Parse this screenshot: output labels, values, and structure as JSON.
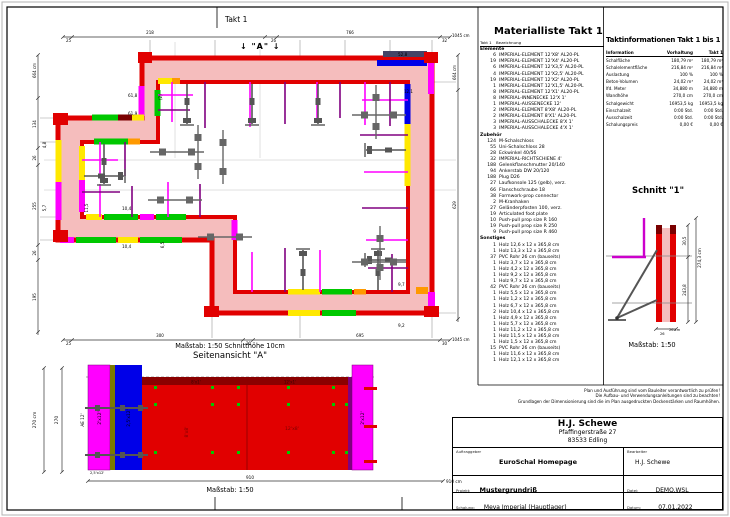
{
  "colors": {
    "formwork_red": "#e10000",
    "dark_red": "#7a0000",
    "wall_pink": "#f5bdbd",
    "magenta": "#ff00ff",
    "blue": "#0000e8",
    "green": "#00c800",
    "yellow": "#ffe800",
    "orange": "#ff9900",
    "purple_prop": "#800080",
    "tie_gray": "#555555"
  },
  "plan": {
    "title": "Takt 1",
    "section_marker": "↓ \"A\" ↓",
    "scale_note": "Maßstab: 1:50   Schnitthöhe 10cm",
    "labels": [
      {
        "t": "25",
        "x": 66,
        "y": 42,
        "s": 4
      },
      {
        "t": "218",
        "x": 150,
        "y": 34,
        "s": 4,
        "a": "middle"
      },
      {
        "t": "26",
        "x": 271,
        "y": 42,
        "s": 4
      },
      {
        "t": "766",
        "x": 350,
        "y": 34,
        "s": 4,
        "a": "middle"
      },
      {
        "t": "32",
        "x": 442,
        "y": 42,
        "s": 4
      },
      {
        "t": "1045 cm",
        "x": 452,
        "y": 37,
        "s": 4
      },
      {
        "t": "25",
        "x": 66,
        "y": 345,
        "s": 4
      },
      {
        "t": "300",
        "x": 160,
        "y": 337,
        "s": 4,
        "a": "middle"
      },
      {
        "t": "20",
        "x": 246,
        "y": 345,
        "s": 4
      },
      {
        "t": "695",
        "x": 360,
        "y": 337,
        "s": 4,
        "a": "middle"
      },
      {
        "t": "30",
        "x": 442,
        "y": 345,
        "s": 4
      },
      {
        "t": "1045 cm",
        "x": 452,
        "y": 341,
        "s": 4
      },
      {
        "t": "664 cm",
        "x": 36,
        "y": 78,
        "r": -90,
        "s": 4
      },
      {
        "t": "134",
        "x": 36,
        "y": 124,
        "r": -90,
        "s": 4,
        "a": "middle"
      },
      {
        "t": "26",
        "x": 36,
        "y": 158,
        "r": -90,
        "s": 4,
        "a": "middle"
      },
      {
        "t": "255",
        "x": 36,
        "y": 206,
        "r": -90,
        "s": 4,
        "a": "middle"
      },
      {
        "t": "26",
        "x": 36,
        "y": 253,
        "r": -90,
        "s": 4,
        "a": "middle"
      },
      {
        "t": "195",
        "x": 36,
        "y": 297,
        "r": -90,
        "s": 4,
        "a": "middle"
      },
      {
        "t": "664 cm",
        "x": 456,
        "y": 80,
        "r": -90,
        "s": 4
      },
      {
        "t": "629",
        "x": 456,
        "y": 205,
        "r": -90,
        "s": 4,
        "a": "middle"
      },
      {
        "t": "52,8",
        "x": 398,
        "y": 56,
        "s": 4.2
      },
      {
        "t": "12,1",
        "x": 404,
        "y": 93,
        "s": 4
      },
      {
        "t": "(2)",
        "x": 162,
        "y": 100,
        "r": -90,
        "s": 4
      },
      {
        "t": "61,8",
        "x": 128,
        "y": 97,
        "s": 4.2
      },
      {
        "t": "61,9",
        "x": 128,
        "y": 115,
        "s": 4.2
      },
      {
        "t": "4,8",
        "x": 46,
        "y": 145,
        "r": -90,
        "s": 4,
        "a": "middle"
      },
      {
        "t": "5,7",
        "x": 46,
        "y": 208,
        "r": -90,
        "s": 4,
        "a": "middle"
      },
      {
        "t": "11,5",
        "x": 88,
        "y": 208,
        "r": -90,
        "s": 4,
        "a": "middle"
      },
      {
        "t": "10,4",
        "x": 122,
        "y": 210,
        "s": 4.2
      },
      {
        "t": "10,4",
        "x": 122,
        "y": 248,
        "s": 4.2
      },
      {
        "t": "6,5",
        "x": 164,
        "y": 245,
        "r": -90,
        "s": 4,
        "a": "middle"
      },
      {
        "t": "9,7",
        "x": 398,
        "y": 286,
        "s": 4.2
      },
      {
        "t": "9,2",
        "x": 398,
        "y": 327,
        "s": 4.2
      }
    ]
  },
  "side_view": {
    "title": "Seitenansicht \"A\"",
    "scale": "Maßstab: 1:50",
    "labels": [
      {
        "t": "270 cm",
        "x": 36,
        "y": 420,
        "r": -90,
        "s": 4.4,
        "a": "middle"
      },
      {
        "t": "270",
        "x": 58,
        "y": 420,
        "r": -90,
        "s": 4.4,
        "a": "middle"
      },
      {
        "t": "AE 12'",
        "x": 84,
        "y": 420,
        "r": -90,
        "s": 4.2,
        "a": "middle"
      },
      {
        "t": "2'x12'",
        "x": 101,
        "y": 418,
        "r": -90,
        "s": 4.4,
        "a": "middle"
      },
      {
        "t": "2,5'x12'",
        "x": 130,
        "y": 418,
        "r": -90,
        "s": 4.4,
        "a": "middle"
      },
      {
        "t": "8'x1'",
        "x": 196,
        "y": 383.5,
        "s": 4,
        "a": "middle",
        "c": "#3a0000"
      },
      {
        "t": "12'x1'",
        "x": 290,
        "y": 383.5,
        "s": 4,
        "a": "middle",
        "c": "#3a0000"
      },
      {
        "t": "8'x8'",
        "x": 188,
        "y": 432,
        "r": -90,
        "s": 4.6,
        "a": "middle",
        "c": "#7a0000"
      },
      {
        "t": "12'x8'",
        "x": 292,
        "y": 430,
        "s": 4.6,
        "a": "middle",
        "c": "#7a0000"
      },
      {
        "t": "2'x12'",
        "x": 364,
        "y": 418,
        "r": -90,
        "s": 4.4,
        "a": "middle"
      },
      {
        "t": "2,5'x12'",
        "x": 90,
        "y": 474,
        "s": 3.6
      },
      {
        "t": "910",
        "x": 250,
        "y": 479,
        "s": 4.2,
        "a": "middle"
      },
      {
        "t": "910 cm",
        "x": 446,
        "y": 483,
        "s": 4.2
      }
    ]
  },
  "schnitt": {
    "title": "Schnitt \"1\"",
    "scale": "Maßstab: 1:50",
    "labels": [
      {
        "t": "274,3 cm",
        "x": 701,
        "y": 258,
        "r": -90,
        "s": 4.2,
        "a": "middle"
      },
      {
        "t": "30,5",
        "x": 686,
        "y": 241,
        "r": -90,
        "s": 4,
        "a": "middle"
      },
      {
        "t": "243,8",
        "x": 686,
        "y": 290,
        "r": -90,
        "s": 4,
        "a": "middle"
      },
      {
        "t": "26 cm",
        "x": 669,
        "y": 331,
        "s": 3.6
      },
      {
        "t": "26",
        "x": 660,
        "y": 335,
        "s": 3.6
      }
    ]
  },
  "materialliste": {
    "title": "Materialliste  Takt 1",
    "header": {
      "takt": "Takt 1",
      "bezeichnung": "Bezeichnung"
    },
    "groups": [
      {
        "name": "Elemente",
        "items": [
          {
            "qty": "6",
            "label": "IMPERIAL-ELEMENT 12'X8'  AL20-PL"
          },
          {
            "qty": "19",
            "label": "IMPERIAL-ELEMENT 12'X4'  AL20-PL"
          },
          {
            "qty": "6",
            "label": "IMPERIAL-ELEMENT 12'X3,5'  AL20-PL"
          },
          {
            "qty": "4",
            "label": "IMPERIAL-ELEMENT 12'X2,5'  AL20-PL"
          },
          {
            "qty": "19",
            "label": "IMPERIAL-ELEMENT 12'X2'  AL20-PL"
          },
          {
            "qty": "1",
            "label": "IMPERIAL-ELEMENT 12'X1,5'  AL20-PL"
          },
          {
            "qty": "8",
            "label": "IMPERIAL-ELEMENT 12'X1'  AL20-PL"
          },
          {
            "qty": "8",
            "label": "IMPERIAL-INNENECKE  12'X 1'"
          },
          {
            "qty": "1",
            "label": "IMPERIAL-AUSSENECKE  12'"
          },
          {
            "qty": "2",
            "label": "IMPERIAL-ELEMENT 8'X8'  AL20-PL"
          },
          {
            "qty": "2",
            "label": "IMPERIAL-ELEMENT 8'X1'  AL20-PL"
          },
          {
            "qty": "3",
            "label": "IMPERIAL-AUSSCHALECKE  8'X 1'"
          },
          {
            "qty": "3",
            "label": "IMPERIAL-AUSSCHALECKE  4'X 1'"
          }
        ]
      },
      {
        "name": "Zubehör",
        "items": [
          {
            "qty": "124",
            "label": "M-Schalschloss"
          },
          {
            "qty": "55",
            "label": "Uni-Schalschloss 28"
          },
          {
            "qty": "28",
            "label": "Eckwinkel 40/56"
          },
          {
            "qty": "32",
            "label": "IMPERIAL-RICHTSCHIENE  4'"
          },
          {
            "qty": "188",
            "label": "Gelenkflanschmutter 20/140"
          },
          {
            "qty": "94",
            "label": "Ankerstab DW 20/120"
          },
          {
            "qty": "188",
            "label": "Plug D26"
          },
          {
            "qty": "27",
            "label": "Laufkonsole 125 (gelb), verz."
          },
          {
            "qty": "66",
            "label": "Flanschschraube 18"
          },
          {
            "qty": "38",
            "label": "Formwork-prop connector"
          },
          {
            "qty": "2",
            "label": "M-Kranhaken"
          },
          {
            "qty": "27",
            "label": "Geländerpfosten 100, verz."
          },
          {
            "qty": "19",
            "label": "Articulated foot plate"
          },
          {
            "qty": "10",
            "label": "Push-pull prop size R 160"
          },
          {
            "qty": "19",
            "label": "Push-pull prop size R 250"
          },
          {
            "qty": "9",
            "label": "Push-pull prop size R 460"
          }
        ]
      },
      {
        "name": "Sonstiges",
        "items": [
          {
            "qty": "1",
            "label": "Holz 12,6 x 12 x 365,8 cm"
          },
          {
            "qty": "1",
            "label": "Holz 13,3 x 12 x 365,8 cm"
          },
          {
            "qty": "37",
            "label": "PVC Rohr 26 cm (bauseits)"
          },
          {
            "qty": "1",
            "label": "Holz 3,7 x 12 x 365,8 cm"
          },
          {
            "qty": "1",
            "label": "Holz 4,2 x 12 x 365,8 cm"
          },
          {
            "qty": "1",
            "label": "Holz 9,2 x 12 x 365,8 cm"
          },
          {
            "qty": "1",
            "label": "Holz 9,7 x 12 x 365,8 cm"
          },
          {
            "qty": "42",
            "label": "PVC Rohr 26 cm (bauseits)"
          },
          {
            "qty": "1",
            "label": "Holz 5,5 x 12 x 365,8 cm"
          },
          {
            "qty": "1",
            "label": "Holz 1,2 x 12 x 365,8 cm"
          },
          {
            "qty": "1",
            "label": "Holz 6,7 x 12 x 365,8 cm"
          },
          {
            "qty": "2",
            "label": "Holz 10,4 x 12 x 365,8 cm"
          },
          {
            "qty": "1",
            "label": "Holz 4,9 x 12 x 365,8 cm"
          },
          {
            "qty": "1",
            "label": "Holz 5,7 x 12 x 365,8 cm"
          },
          {
            "qty": "1",
            "label": "Holz 11,2 x 12 x 365,8 cm"
          },
          {
            "qty": "1",
            "label": "Holz 11,5 x 12 x 365,8 cm"
          },
          {
            "qty": "1",
            "label": "Holz 1,5 x 12 x 365,8 cm"
          },
          {
            "qty": "15",
            "label": "PVC Rohr 26 cm (bauseits)"
          },
          {
            "qty": "1",
            "label": "Holz 11,6 x 12 x 365,8 cm"
          },
          {
            "qty": "1",
            "label": "Holz 12,1 x 12 x 365,8 cm"
          }
        ]
      }
    ]
  },
  "taktinfo": {
    "title": "Taktinformationen  Takt 1 bis 1",
    "columns": [
      "Information",
      "Vorhaltung",
      "Takt 1"
    ],
    "rows": [
      [
        "Schalfläche",
        "180,79 m²",
        "180,79 m²"
      ],
      [
        "Schalelementfläche",
        "216,84 m²",
        "216,84 m²"
      ],
      [
        "Auslastung",
        "100 %",
        "100 %"
      ],
      [
        "Beton-Volumen",
        "24,02 m³",
        "24,02 m³"
      ],
      [
        "lfd. Meter",
        "34,880 m",
        "34,880 m"
      ],
      [
        "Wandhöhe",
        "270,0 cm",
        "270,0 cm"
      ],
      [
        "Schalgewicht",
        "16953,5 kg",
        "16953,5 kg"
      ],
      [
        "Einschalzeit",
        "0:00 Std.",
        "0:00 Std."
      ],
      [
        "Ausschalzeit",
        "0:00 Std.",
        "0:00 Std."
      ],
      [
        "Schalungspreis",
        "0,00 €",
        "0,00 €"
      ]
    ]
  },
  "disclaimer": {
    "lines": [
      "Plan und Ausführung sind vom Bauleiter verantwortlich zu prüfen!",
      "Die Aufbau- und Verwendungsanleitungen sind zu beachten!",
      "Grundlagen der Dimensionierung sind die im Plan ausgedruckten Deckenstärken und Raumhöhen."
    ]
  },
  "title_block": {
    "company_name": "H.J. Schewe",
    "company_street": "Pfaffingerstraße 27",
    "company_city": "83533 Edling",
    "auftraggeber_label": "Auftraggeber",
    "auftraggeber": "EuroSchal Homepage",
    "bearbeiter_label": "Bearbeiter",
    "bearbeiter": "H.J. Schewe",
    "projekt_label": "Projekt:",
    "projekt": "Mustergrundriß",
    "datei_label": "Datei:",
    "datei": "DEMO.WSL",
    "schalung_label": "Schalung:",
    "schalung": "Meva Imperial (Hauptlager)",
    "datum_label": "Datum:",
    "datum": "07.01.2022"
  }
}
